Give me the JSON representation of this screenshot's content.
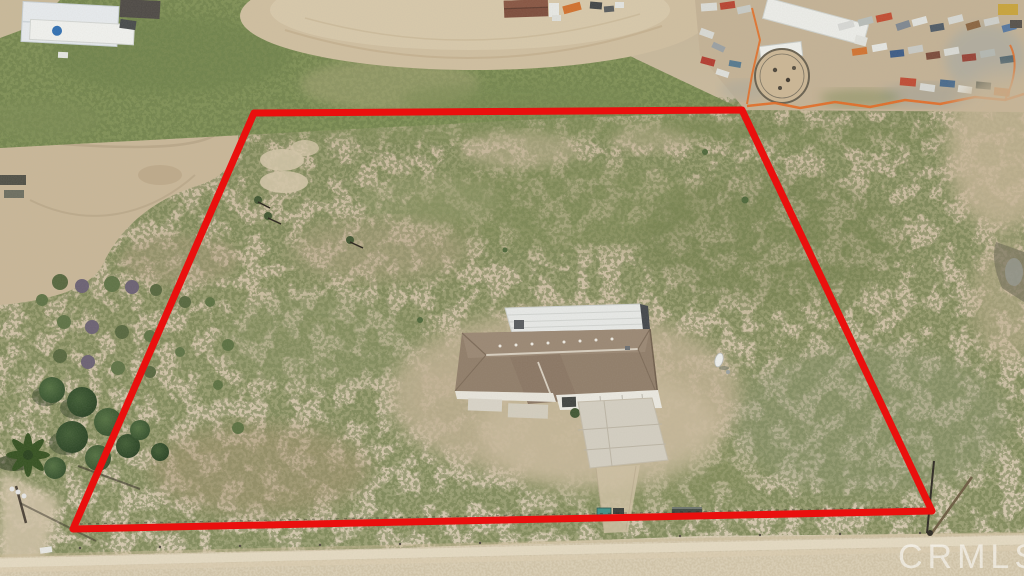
{
  "watermark": {
    "text": "CRMLS",
    "color": "#ffffff",
    "opacity": "0.55"
  },
  "boundary": {
    "color": "#ea100e",
    "stroke_width": "7",
    "points": "254,113 742,110 932,511 73,529"
  },
  "palette": {
    "desert_ground": "#c8b89b",
    "scrub_green": "#7d8a55",
    "scrub_speckle": "#6c7a48",
    "grass_green": "#7f9055",
    "arena_dirt": "#d0bfa0",
    "dirt_track": "#c9b798",
    "house_roof_brown": "#907d69",
    "rv_garage_white": "#e8eae8",
    "concrete": "#d4cfc2",
    "road_tan": "#dbcfb5",
    "safety_fence_orange": "#e5681f"
  }
}
